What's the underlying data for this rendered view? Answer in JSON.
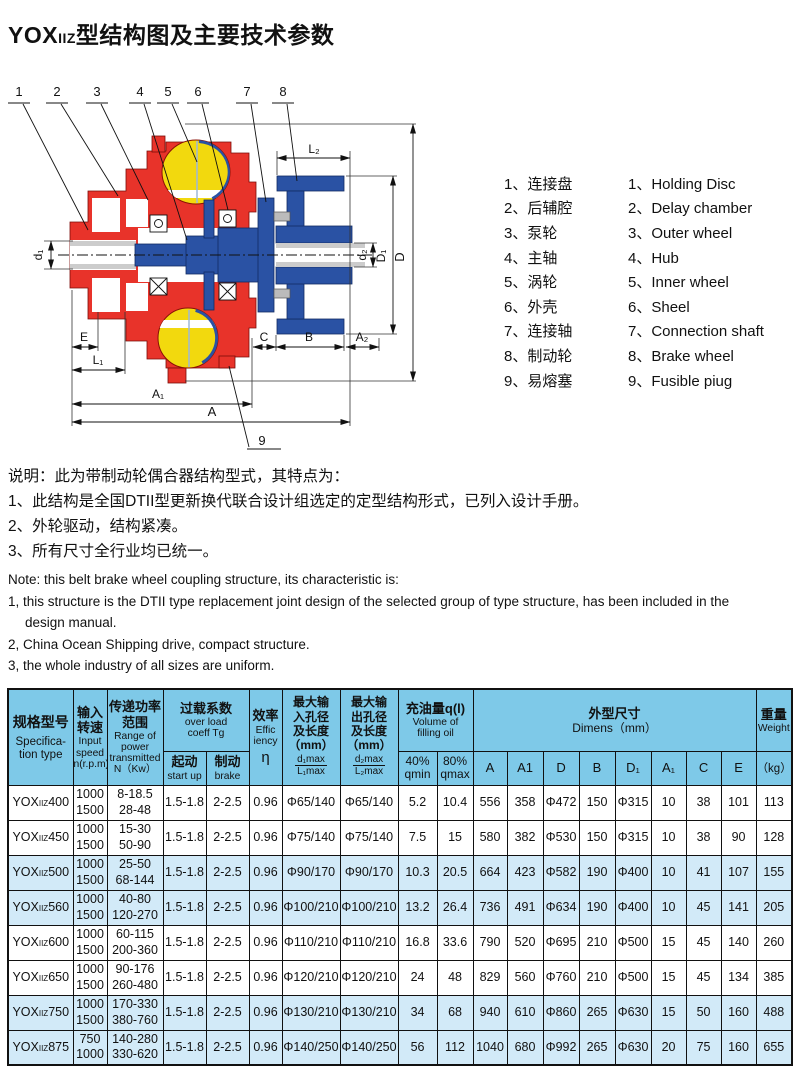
{
  "title": {
    "prefix": "YOX",
    "sub": "IIZ",
    "rest": "型结构图及主要技术参数"
  },
  "legend": {
    "items": [
      {
        "n": "1",
        "zh": "连接盘",
        "en": "Holding Disc"
      },
      {
        "n": "2",
        "zh": "后辅腔",
        "en": "Delay chamber"
      },
      {
        "n": "3",
        "zh": "泵轮",
        "en": "Outer wheel"
      },
      {
        "n": "4",
        "zh": "主轴",
        "en": "Hub"
      },
      {
        "n": "5",
        "zh": "涡轮",
        "en": "Inner wheel"
      },
      {
        "n": "6",
        "zh": "外壳",
        "en": "Sheel"
      },
      {
        "n": "7",
        "zh": "连接轴",
        "en": "Connection shaft"
      },
      {
        "n": "8",
        "zh": "制动轮",
        "en": "Brake wheel"
      },
      {
        "n": "9",
        "zh": "易熔塞",
        "en": "Fusible piug"
      }
    ]
  },
  "notes": {
    "zh": [
      "说明：此为带制动轮偶合器结构型式，其特点为：",
      "1、此结构是全国DTII型更新换代联合设计组选定的定型结构形式，已列入设计手册。",
      "2、外轮驱动，结构紧凑。",
      "3、所有尺寸全行业均已统一。"
    ],
    "en": [
      {
        "t": "Note: this belt brake wheel coupling structure, its characteristic is:",
        "i": 0
      },
      {
        "t": "1, this structure is the DTII type replacement joint design of the selected group of type structure, has been included in the",
        "i": 0
      },
      {
        "t": "design manual.",
        "i": 1
      },
      {
        "t": "2, China Ocean Shipping drive, compact structure.",
        "i": 0
      },
      {
        "t": "3, the whole industry of all sizes are uniform.",
        "i": 0
      }
    ]
  },
  "diagram": {
    "parts": [
      "1",
      "2",
      "3",
      "4",
      "5",
      "6",
      "7",
      "8",
      "9"
    ],
    "dims": {
      "L2": "L₂",
      "d1": "d₁",
      "d2": "d₂",
      "D1": "D₁",
      "D": "D",
      "E": "E",
      "L1": "L₁",
      "C": "C",
      "B": "B",
      "A2": "A₂",
      "A1": "A₁",
      "A": "A"
    },
    "colors": {
      "red": "#e8332a",
      "yellow": "#f2d90e",
      "blue": "#2a52a4"
    }
  },
  "table": {
    "header": {
      "spec": {
        "zh": "规格型号",
        "en": "Specifica-\ntion type"
      },
      "speed": {
        "zh": "输入\n转速",
        "en": "Input\nspeed\nn(r.p.m)"
      },
      "power": {
        "zh": "传递功率\n范围",
        "en": "Range of\npower\ntransmitted\nN（Kw）"
      },
      "overload": {
        "zh": "过载系数",
        "en": "over load\ncoeff Tg"
      },
      "startup": {
        "zh": "起动",
        "en": "start up"
      },
      "brakeh": {
        "zh": "制动",
        "en": "brake"
      },
      "eff": {
        "zh": "效率",
        "en": "Effic\niency",
        "sym": "η"
      },
      "maxin": {
        "zh": "最大输\n入孔径\n及长度\n（mm）",
        "ft": "d₁max",
        "fb": "L₁max"
      },
      "maxout": {
        "zh": "最大输\n出孔径\n及长度\n（mm）",
        "ft": "d₂max",
        "fb": "L₂max"
      },
      "oil": {
        "zh": "充油量q(l)",
        "en": "Volume of\nfilling oil"
      },
      "oil40": "40%\nqmin",
      "oil80": "80%\nqmax",
      "dimens": {
        "zh": "外型尺寸",
        "en": "Dimens（mm）"
      },
      "dims": [
        "A",
        "A1",
        "D",
        "B",
        "D₁",
        "A₁",
        "C",
        "E"
      ],
      "weight": {
        "zh": "重量",
        "en": "Weight",
        "unit": "（kg）"
      }
    },
    "rows": [
      {
        "model": [
          "YOX",
          "IIZ",
          "400"
        ],
        "speed": [
          "1000",
          "1500"
        ],
        "power": [
          "8-18.5",
          "28-48"
        ],
        "vals": [
          "1.5-1.8",
          "2-2.5",
          "0.96",
          "Φ65/140",
          "Φ65/140",
          "5.2",
          "10.4",
          "556",
          "358",
          "Φ472",
          "150",
          "Φ315",
          "10",
          "38",
          "101",
          "113"
        ]
      },
      {
        "model": [
          "YOX",
          "IIZ",
          "450"
        ],
        "speed": [
          "1000",
          "1500"
        ],
        "power": [
          "15-30",
          "50-90"
        ],
        "vals": [
          "1.5-1.8",
          "2-2.5",
          "0.96",
          "Φ75/140",
          "Φ75/140",
          "7.5",
          "15",
          "580",
          "382",
          "Φ530",
          "150",
          "Φ315",
          "10",
          "38",
          "90",
          "128"
        ]
      },
      {
        "model": [
          "YOX",
          "IIZ",
          "500"
        ],
        "speed": [
          "1000",
          "1500"
        ],
        "power": [
          "25-50",
          "68-144"
        ],
        "vals": [
          "1.5-1.8",
          "2-2.5",
          "0.96",
          "Φ90/170",
          "Φ90/170",
          "10.3",
          "20.5",
          "664",
          "423",
          "Φ582",
          "190",
          "Φ400",
          "10",
          "41",
          "107",
          "155"
        ]
      },
      {
        "model": [
          "YOX",
          "IIZ",
          "560"
        ],
        "speed": [
          "1000",
          "1500"
        ],
        "power": [
          "40-80",
          "120-270"
        ],
        "vals": [
          "1.5-1.8",
          "2-2.5",
          "0.96",
          "Φ100/210",
          "Φ100/210",
          "13.2",
          "26.4",
          "736",
          "491",
          "Φ634",
          "190",
          "Φ400",
          "10",
          "45",
          "141",
          "205"
        ]
      },
      {
        "model": [
          "YOX",
          "IIZ",
          "600"
        ],
        "speed": [
          "1000",
          "1500"
        ],
        "power": [
          "60-115",
          "200-360"
        ],
        "vals": [
          "1.5-1.8",
          "2-2.5",
          "0.96",
          "Φ110/210",
          "Φ110/210",
          "16.8",
          "33.6",
          "790",
          "520",
          "Φ695",
          "210",
          "Φ500",
          "15",
          "45",
          "140",
          "260"
        ]
      },
      {
        "model": [
          "YOX",
          "IIZ",
          "650"
        ],
        "speed": [
          "1000",
          "1500"
        ],
        "power": [
          "90-176",
          "260-480"
        ],
        "vals": [
          "1.5-1.8",
          "2-2.5",
          "0.96",
          "Φ120/210",
          "Φ120/210",
          "24",
          "48",
          "829",
          "560",
          "Φ760",
          "210",
          "Φ500",
          "15",
          "45",
          "134",
          "385"
        ]
      },
      {
        "model": [
          "YOX",
          "IIZ",
          "750"
        ],
        "speed": [
          "1000",
          "1500"
        ],
        "power": [
          "170-330",
          "380-760"
        ],
        "vals": [
          "1.5-1.8",
          "2-2.5",
          "0.96",
          "Φ130/210",
          "Φ130/210",
          "34",
          "68",
          "940",
          "610",
          "Φ860",
          "265",
          "Φ630",
          "15",
          "50",
          "160",
          "488"
        ]
      },
      {
        "model": [
          "YOX",
          "IIZ",
          "875"
        ],
        "speed": [
          "750",
          "1000"
        ],
        "power": [
          "140-280",
          "330-620"
        ],
        "vals": [
          "1.5-1.8",
          "2-2.5",
          "0.96",
          "Φ140/250",
          "Φ140/250",
          "56",
          "112",
          "1040",
          "680",
          "Φ992",
          "265",
          "Φ630",
          "20",
          "75",
          "160",
          "655"
        ]
      }
    ]
  }
}
